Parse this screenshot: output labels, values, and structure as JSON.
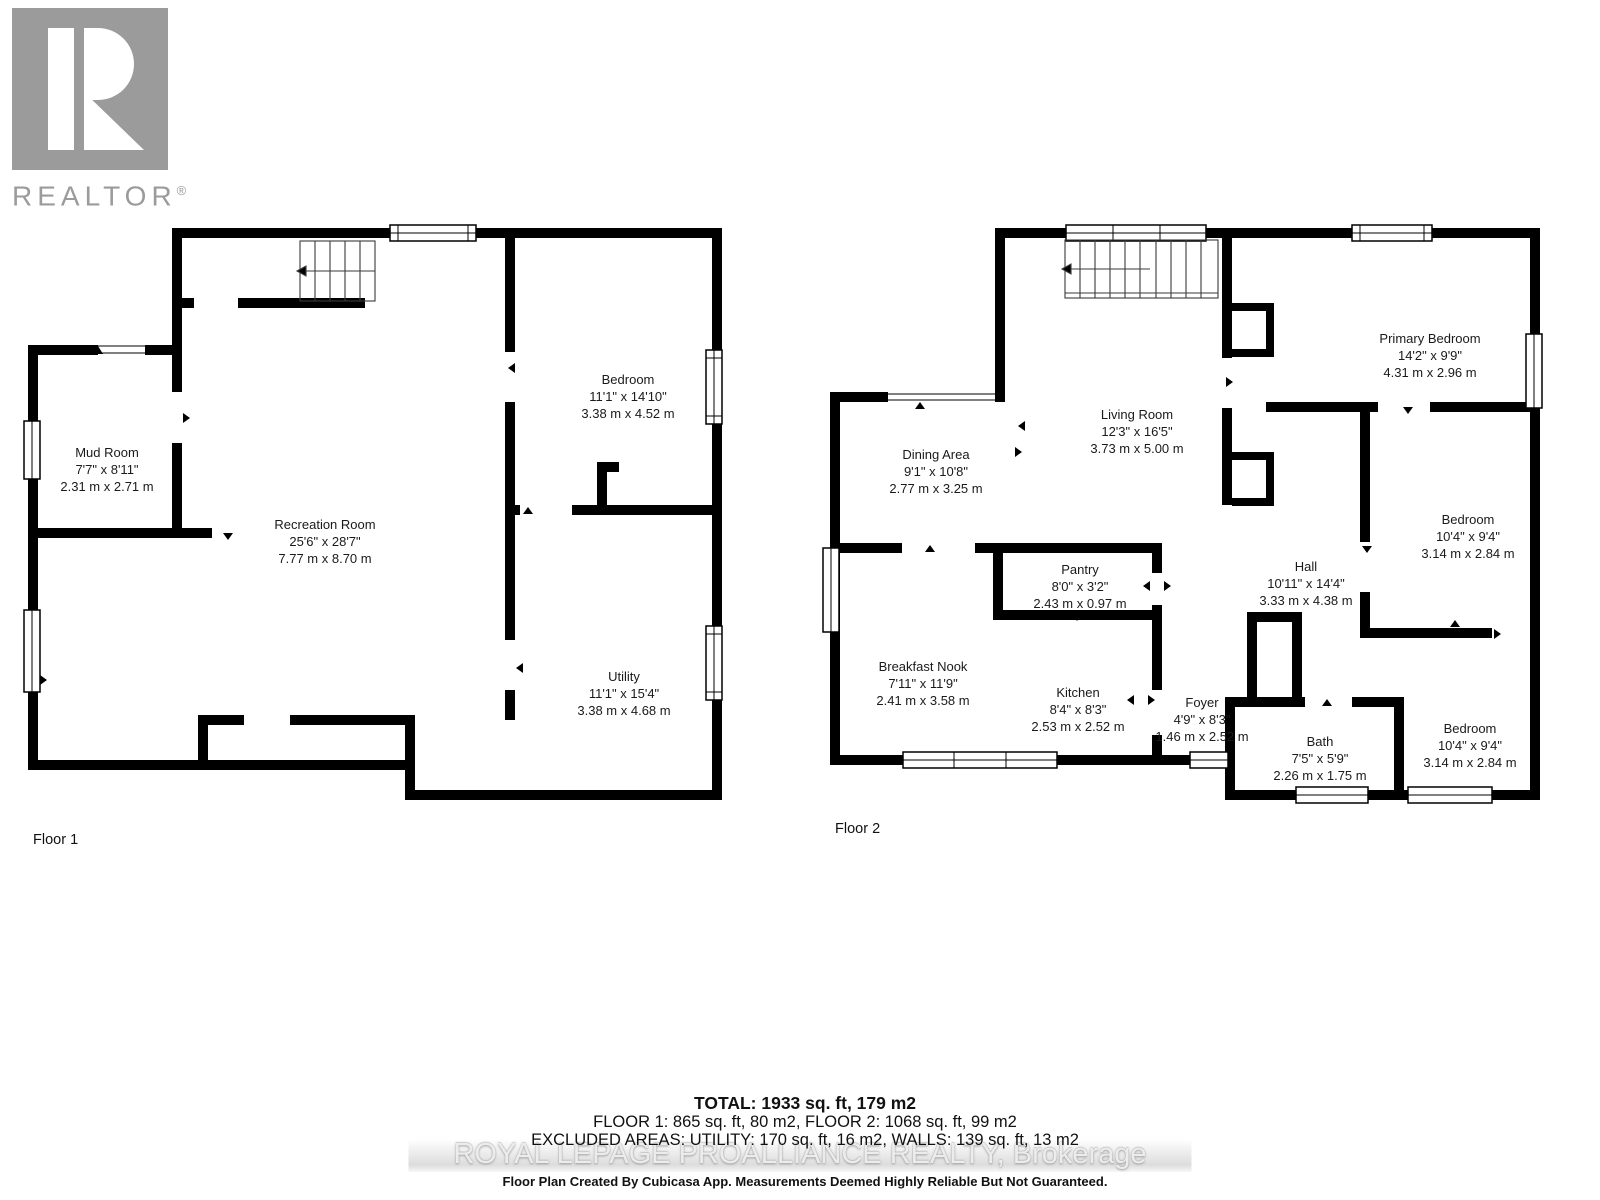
{
  "logo": {
    "name": "REALTOR",
    "registered": "®"
  },
  "floor1": {
    "label": "Floor 1",
    "rooms": [
      {
        "name": "Mud Room",
        "imperial": "7'7\" x 8'11\"",
        "metric": "2.31 m x 2.71 m"
      },
      {
        "name": "Recreation Room",
        "imperial": "25'6\" x 28'7\"",
        "metric": "7.77 m x 8.70 m"
      },
      {
        "name": "Bedroom",
        "imperial": "11'1\" x 14'10\"",
        "metric": "3.38 m x 4.52 m"
      },
      {
        "name": "Utility",
        "imperial": "11'1\" x 15'4\"",
        "metric": "3.38 m x 4.68 m"
      }
    ]
  },
  "floor2": {
    "label": "Floor 2",
    "rooms": [
      {
        "name": "Dining Area",
        "imperial": "9'1\" x 10'8\"",
        "metric": "2.77 m x 3.25 m"
      },
      {
        "name": "Living Room",
        "imperial": "12'3\" x 16'5\"",
        "metric": "3.73 m x 5.00 m"
      },
      {
        "name": "Primary Bedroom",
        "imperial": "14'2\" x 9'9\"",
        "metric": "4.31 m x 2.96 m"
      },
      {
        "name": "Pantry",
        "imperial": "8'0\" x 3'2\"",
        "metric": "2.43 m x 0.97 m"
      },
      {
        "name": "Hall",
        "imperial": "10'11\" x 14'4\"",
        "metric": "3.33 m x 4.38 m"
      },
      {
        "name": "Bedroom",
        "imperial": "10'4\" x 9'4\"",
        "metric": "3.14 m x 2.84 m"
      },
      {
        "name": "Breakfast Nook",
        "imperial": "7'11\" x 11'9\"",
        "metric": "2.41 m x 3.58 m"
      },
      {
        "name": "Kitchen",
        "imperial": "8'4\" x 8'3\"",
        "metric": "2.53 m x 2.52 m"
      },
      {
        "name": "Foyer",
        "imperial": "4'9\" x 8'3\"",
        "metric": "1.46 m x 2.52 m"
      },
      {
        "name": "Bath",
        "imperial": "7'5\" x 5'9\"",
        "metric": "2.26 m x 1.75 m"
      },
      {
        "name": "Bedroom",
        "imperial": "10'4\" x 9'4\"",
        "metric": "3.14 m x 2.84 m"
      }
    ]
  },
  "summary": {
    "total": "TOTAL: 1933 sq. ft, 179 m2",
    "floors": "FLOOR 1: 865 sq. ft, 80 m2, FLOOR 2: 1068 sq. ft, 99 m2",
    "excluded": "EXCLUDED AREAS: UTILITY: 170 sq. ft, 16 m2, WALLS: 139 sq. ft, 13 m2",
    "watermark": "ROYAL LEPAGE PROALLIANCE REALTY, Brokerage",
    "disclaimer": "Floor Plan Created By Cubicasa App. Measurements Deemed Highly Reliable But Not Guaranteed."
  },
  "colors": {
    "wall": "#000000",
    "logo_gray": "#9b9b9b",
    "watermark_gray": "#ececec"
  }
}
